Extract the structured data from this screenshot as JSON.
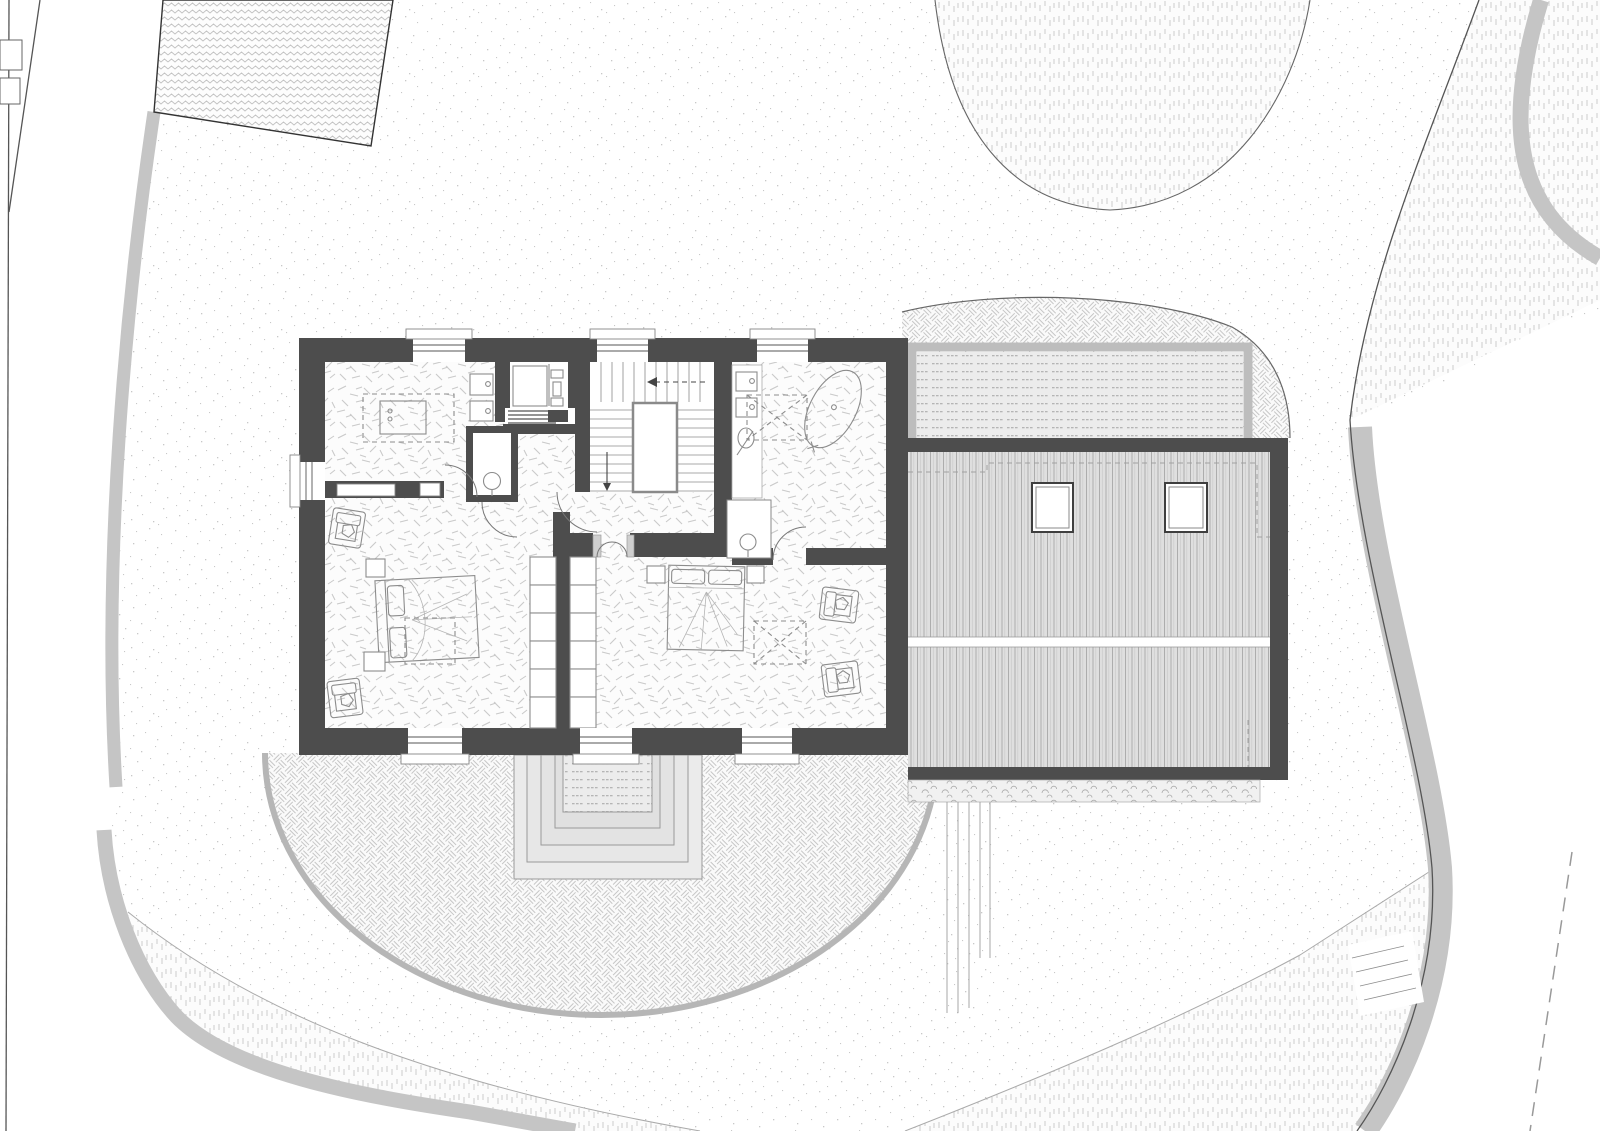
{
  "document": {
    "kind": "architectural drawing",
    "view": "upper floor plan with roof of side wing and site plan",
    "visible_text": [],
    "scale_bar": "none",
    "north_arrow": "none"
  },
  "colors": {
    "background": "#ffffff",
    "wall": "#4d4d4d",
    "curb": "#c5c5c5",
    "site_line": "#555555",
    "property_dash": "#999999",
    "floor_hatch": "#c9c9c9",
    "stipple": "#9a9a9a",
    "grass": "#cccccc",
    "herringbone": "#c6c6c6",
    "zigzag": "#c2c2c2",
    "roof_fill": "#dfdfdf",
    "roof_stripe": "#a8a8a8",
    "ridge": "#ffffff",
    "terrace_frame": "#bdbdbd",
    "deck_dot": "#b5b5b5",
    "pebble": "#a8a8a8",
    "fixture": "#8c8c8c",
    "door": "#777777",
    "glazing": "#555555",
    "porch_step_fill": "#ebebeb"
  },
  "site": {
    "ground_textures": [
      {
        "name": "gravel",
        "pattern": "stipple dots",
        "coverage": "main garden"
      },
      {
        "name": "lawn",
        "pattern": "rows of short vertical dashes",
        "locations": [
          "top center U-shaped bed",
          "top-right corner band",
          "bottom-left wedge",
          "bottom-right slope"
        ]
      },
      {
        "name": "paving",
        "pattern": "herringbone",
        "locations": [
          "semicircular garden terrace at bottom",
          "band around roof terrace at top right"
        ]
      }
    ],
    "boundaries": {
      "left_lines": 2,
      "right_edge_curved": true,
      "property_dashed_line_bottom_right": true,
      "retaining_curbs": 4
    },
    "neighbor_building": {
      "position": "top-left",
      "hatch": "zigzag",
      "rotated": true
    },
    "external_stair": {
      "position": "bottom-right boundary band",
      "treads": 4
    },
    "garden_path": {
      "position": "below roof wing",
      "parallel_lines": 5
    },
    "left_edge_markers": 2
  },
  "building": {
    "rooms": [
      {
        "name": "dressing-bathroom",
        "position": "top-left",
        "fixtures": [
          "vanity island with dashed surround",
          "wall-hung toilet",
          "wall-hung bidet"
        ]
      },
      {
        "name": "elevator",
        "position": "top center-left",
        "fixtures": [
          "elevator cab",
          "door mechanism",
          "shaft vent lines"
        ]
      },
      {
        "name": "stair-hall",
        "position": "top center",
        "fixtures": [
          "U-shaped stair",
          "central void",
          "down arrow",
          "up arrow"
        ]
      },
      {
        "name": "bathroom",
        "position": "top-right",
        "fixtures": [
          "two counter sinks",
          "round washbasin",
          "dashed shower square",
          "freestanding oval bathtub"
        ]
      },
      {
        "name": "wc",
        "position": "center",
        "fixtures": [
          "round washbasin"
        ]
      },
      {
        "name": "wc-closet",
        "position": "center-right",
        "fixtures": [
          "round washbasin"
        ]
      },
      {
        "name": "bedroom-1",
        "position": "bottom-left",
        "fixtures": [
          "double bed",
          "2 nightstands",
          "2 armchairs",
          "dashed rug",
          "wardrobe cells"
        ]
      },
      {
        "name": "bedroom-2",
        "position": "bottom-right",
        "fixtures": [
          "double bed",
          "2 nightstands",
          "2 armchairs",
          "dashed rug with X",
          "wardrobe cells"
        ]
      }
    ],
    "windows": {
      "top_wall": 3,
      "bottom_wall": 3,
      "left_wall": 1
    },
    "interior_doors": 6,
    "double_swing_door": 1
  },
  "roof_wing": {
    "cladding": "standing-seam vertical stripes",
    "ridge": "horizontal white double line",
    "skylights": 2,
    "dashed_outline_of_floor_below": true
  },
  "roof_terrace": {
    "frame": "light gray railing on three sides",
    "deck": "dotted board texture"
  },
  "garden_terrace": {
    "shape": "semicircle",
    "paving": "herringbone",
    "entry_steps": 4
  },
  "pebble_strip": {
    "position": "below roof wing",
    "texture": "scalloped pebbles"
  }
}
